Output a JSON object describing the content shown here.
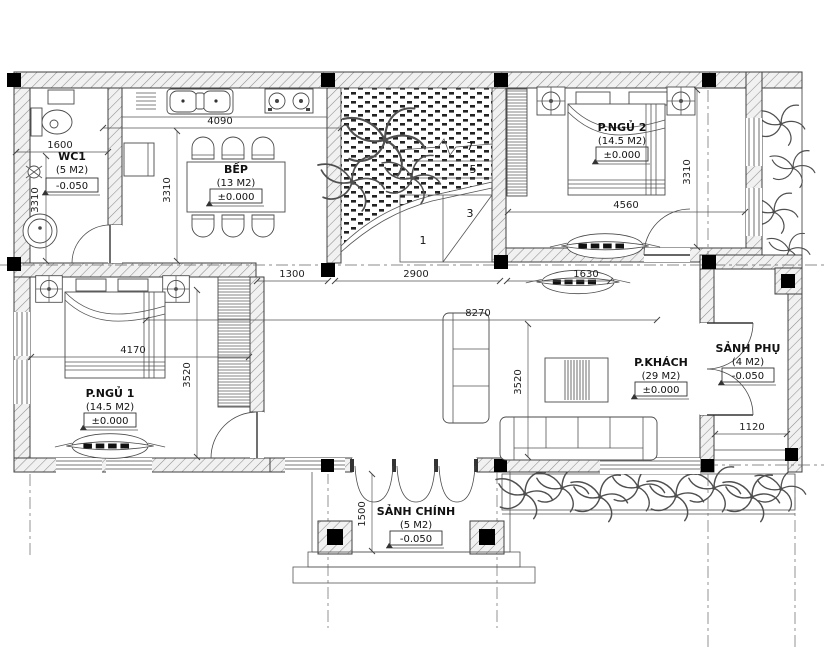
{
  "meta": {
    "type": "architectural floor plan",
    "style": "CAD black and white line drawing"
  },
  "colors": {
    "background": "#ffffff",
    "line": "#3f3f3f",
    "wall_hatch": "#8f8f8f",
    "column": "#000000",
    "text": "#111111"
  },
  "rooms": {
    "wc1": {
      "name": "WC1",
      "area": "(5 M2)",
      "level": "-0.050"
    },
    "bep": {
      "name": "BẾP",
      "area": "(13 M2)",
      "level": "±0.000"
    },
    "p_ngu_2": {
      "name": "P.NGỦ 2",
      "area": "(14.5 M2)",
      "level": "±0.000"
    },
    "p_ngu_1": {
      "name": "P.NGỦ 1",
      "area": "(14.5 M2)",
      "level": "±0.000"
    },
    "p_khach": {
      "name": "P.KHÁCH",
      "area": "(29 M2)",
      "level": "±0.000"
    },
    "sanh_phu": {
      "name": "SẢNH PHỤ",
      "area": "(4 M2)",
      "level": "-0.050"
    },
    "sanh_chinh": {
      "name": "SẢNH CHÍNH",
      "area": "(5 M2)",
      "level": "-0.050"
    }
  },
  "dimensions": {
    "kitchen_width": "4090",
    "wc_width": "1600",
    "wc_depth": "3310",
    "kitchen_depth": "3310",
    "bedroom2_depth": "3310",
    "bedroom2_width": "4560",
    "hallway_width": "1300",
    "stairwell_width": "2900",
    "bedroom2_entry": "1630",
    "bedroom1_width": "4170",
    "bedroom1_depth": "3520",
    "living_depth": "3520",
    "living_width": "8270",
    "side_porch_width": "1120",
    "main_porch_depth": "1500"
  },
  "stairs": {
    "n1": "1",
    "n3": "3",
    "n5": "5",
    "n7": "7"
  }
}
